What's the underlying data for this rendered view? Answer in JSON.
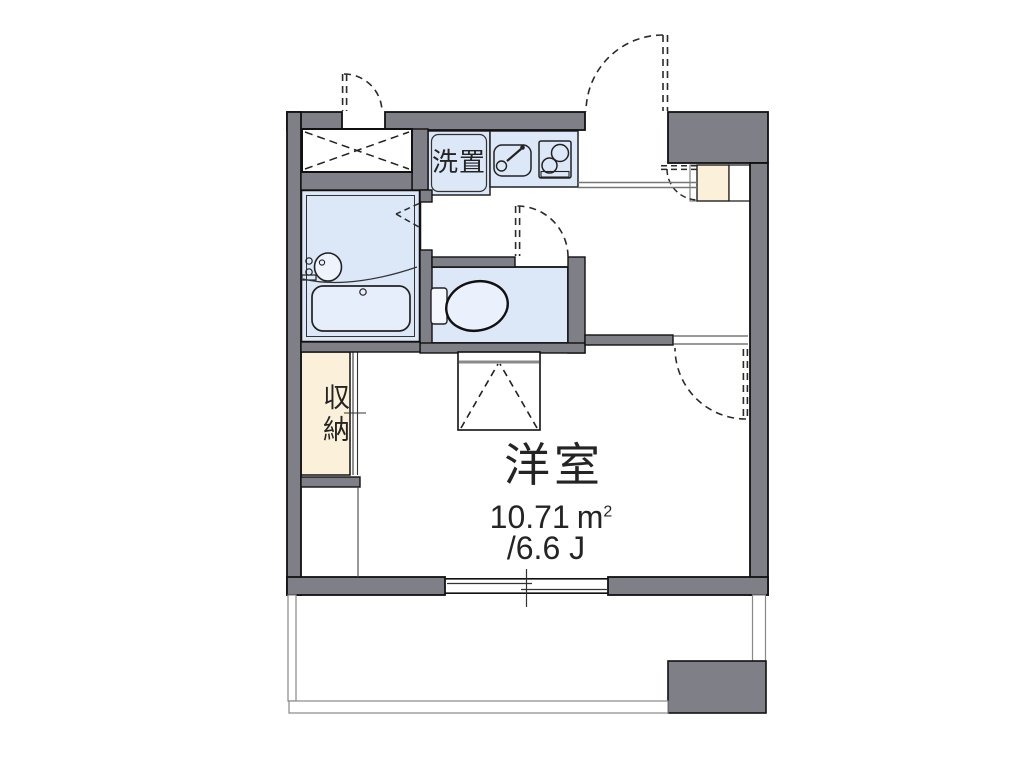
{
  "floor_plan": {
    "main_room": {
      "label": "洋室",
      "area_value": "10.71",
      "area_unit_base": "m",
      "area_unit_exponent": "2",
      "tatami": "/6.6 J"
    },
    "storage_label": "収納",
    "washer_label": "洗置",
    "icons": {
      "kitchen_sink": "sink-icon",
      "stove": "two-burner-stove-icon",
      "washbasin": "washbasin-icon",
      "bathtub": "bathtub-icon",
      "toilet": "toilet-icon",
      "overhead_storage": "crossed-box-icon",
      "doors": "dashed-door-swing-arc",
      "window": "sliding-window-symbol"
    },
    "colors": {
      "wall_gray": "#7f7f87",
      "fixture_blue": "#dce7f7",
      "closet_cream": "#fbf1da",
      "line_dark": "#1c1c1c",
      "background": "#ffffff"
    }
  }
}
